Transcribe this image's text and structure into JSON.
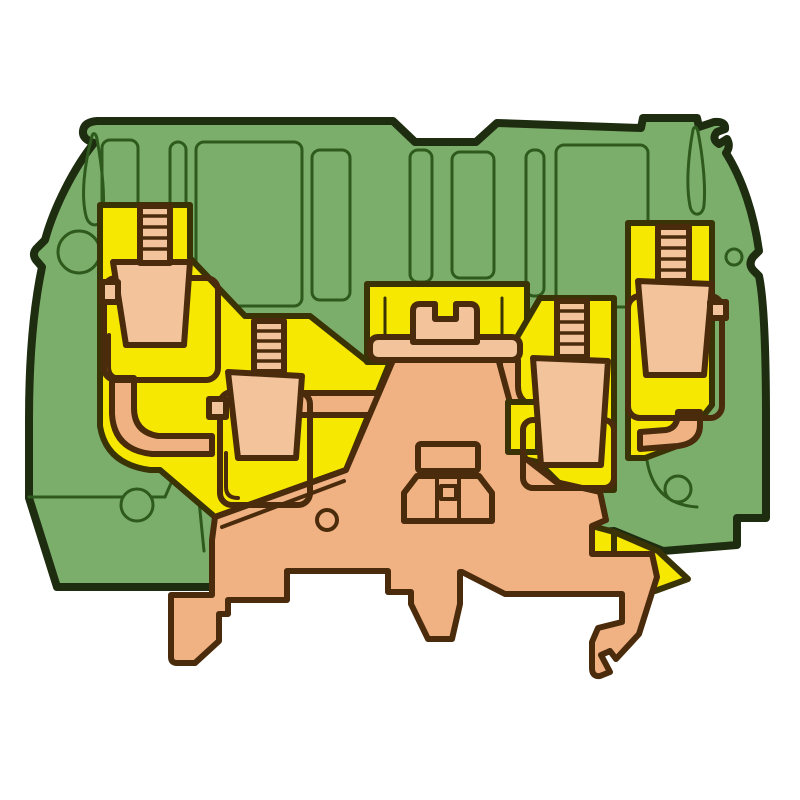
{
  "figure": {
    "title": "Cross-section illustration of a green/yellow grounding DIN-rail terminal block",
    "type": "technical-product-illustration",
    "visible_text": "none"
  },
  "palette": {
    "background": "#ffffff",
    "housing_green": "#7cae6b",
    "housing_outline": "#1e2d10",
    "mold_line_green": "#2e5b1d",
    "insulation_yellow": "#f6e800",
    "yellow_outline": "#3a3305",
    "copper_tan": "#f3c49c",
    "copper_tan_dark": "#f0b183",
    "copper_outline": "#4a2b0c"
  },
  "parts": {
    "housing": "green insulated housing with yellow inner insulation",
    "clamp_count": 4,
    "clamps": [
      "upper-left screw clamp",
      "middle-left screw clamp",
      "middle-right screw clamp",
      "upper-right screw clamp"
    ],
    "other": [
      "center bridge contact",
      "central busbar",
      "cage clamp on DIN-rail foot",
      "DIN-rail mounting foot with left prong, center tab and right hook",
      "test-point teardrop slots",
      "housing holes",
      "latch notch"
    ]
  }
}
